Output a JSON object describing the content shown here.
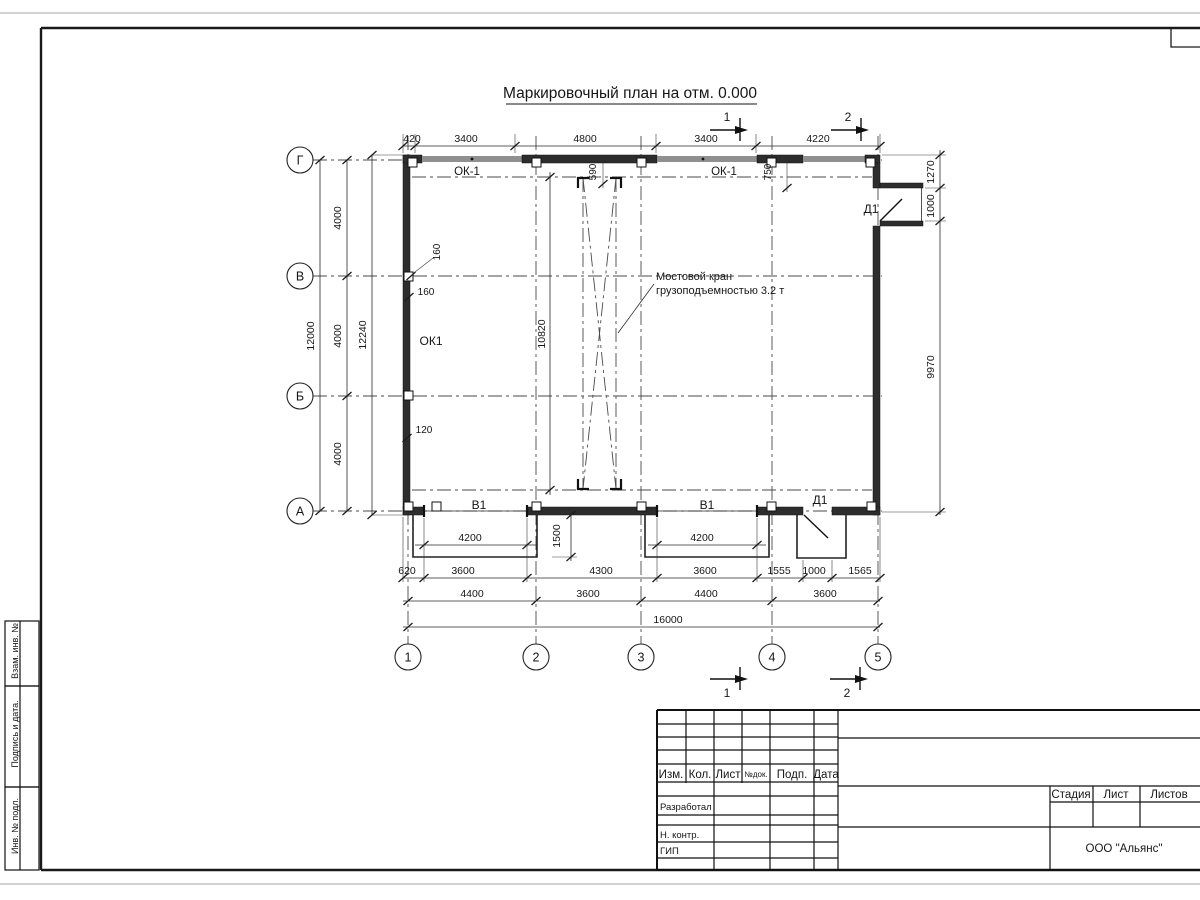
{
  "drawing": {
    "title": "Маркировочный план на отм. 0.000",
    "crane_note": {
      "line1": "Мостовой кран",
      "line2": "грузоподъемностью 3.2 т"
    },
    "axes": {
      "rows": [
        "Г",
        "В",
        "Б",
        "А"
      ],
      "cols": [
        "1",
        "2",
        "3",
        "4",
        "5"
      ]
    },
    "sections": {
      "s1": "1",
      "s2": "2"
    },
    "labels": {
      "window_top_left": "ОК-1",
      "window_top_right": "ОК-1",
      "window_left": "ОК1",
      "gate1": "В1",
      "gate2": "В1",
      "door_right": "Д1",
      "door_bottom": "Д1"
    },
    "dims": {
      "top": [
        "420",
        "3400",
        "4800",
        "3400",
        "4220"
      ],
      "left_segments": [
        "4000",
        "4000",
        "4000"
      ],
      "left_total": "12000",
      "left_overall": "12240",
      "right": [
        "1270",
        "1000",
        "9970"
      ],
      "crane_len": "10820",
      "off_590": "590",
      "off_750": "750",
      "off_160a": "160",
      "off_160b": "160",
      "off_120": "120",
      "gate_w1": "4200",
      "gate_w2": "4200",
      "apron_d": "1500",
      "row_b": [
        "620",
        "3600",
        "4300",
        "3600",
        "1555",
        "1000",
        "1565"
      ],
      "row_c": [
        "4400",
        "3600",
        "4400",
        "3600"
      ],
      "total": "16000"
    }
  },
  "titleblock": {
    "header": [
      "Изм.",
      "Кол.",
      "Лист",
      "№док.",
      "Подп.",
      "Дата"
    ],
    "roles": [
      "Разработал",
      "Н. контр.",
      "ГИП"
    ],
    "right_header": [
      "Стадия",
      "Лист",
      "Листов"
    ],
    "company": "ООО \"Альянс\""
  },
  "side_stamps": [
    "Взам. инв. №",
    "Подпись и дата.",
    "Инв. № подл."
  ]
}
